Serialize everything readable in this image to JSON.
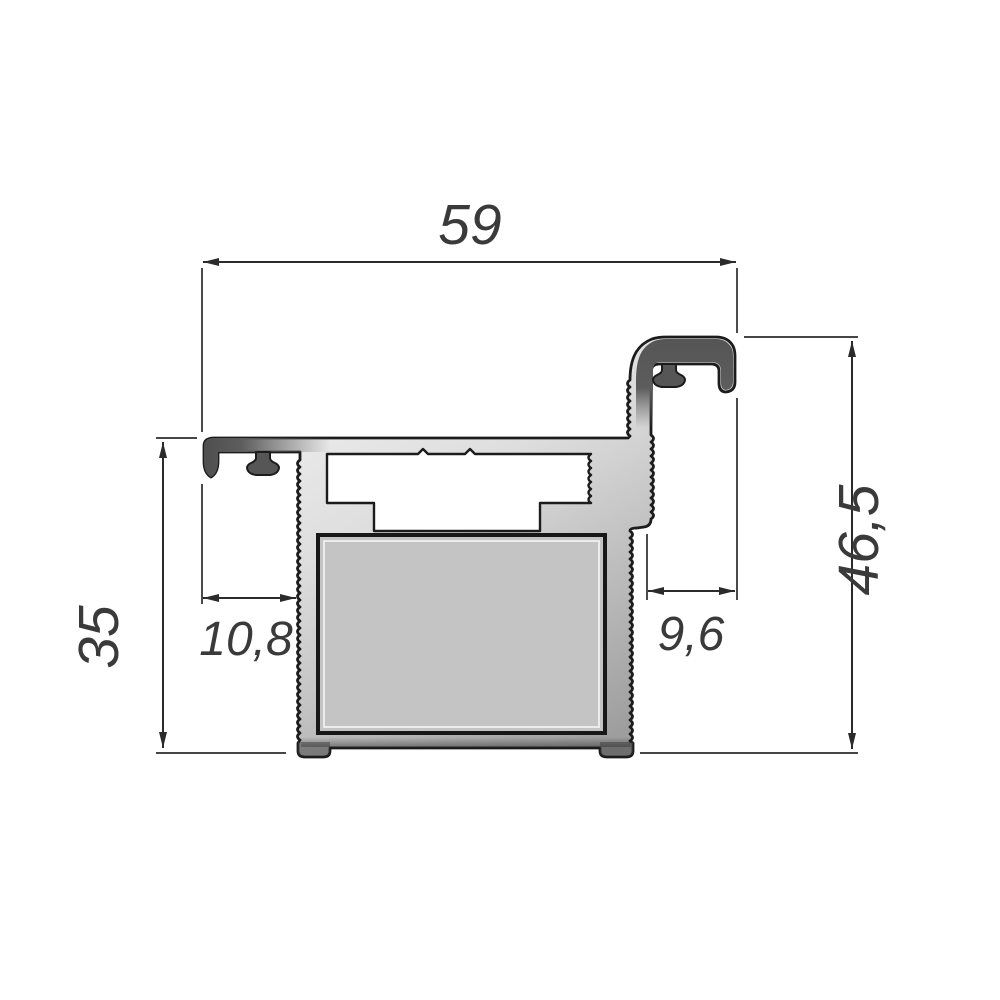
{
  "drawing": {
    "title": "aluminium-profile-cross-section",
    "dimensions": {
      "width_top": "59",
      "height_right": "46,5",
      "height_left": "35",
      "gap_left": "10,8",
      "gap_right": "9,6"
    },
    "colors": {
      "outline": "#1c1c1c",
      "dimension_lines": "#2b2b2b",
      "dimension_text": "#3a3a3a",
      "body_light": "#f2f2f2",
      "body_shadow": "#9e9e9e",
      "anodized_dark": "#565656",
      "panel_fill": "#c4c4c4",
      "background": "#ffffff"
    }
  }
}
